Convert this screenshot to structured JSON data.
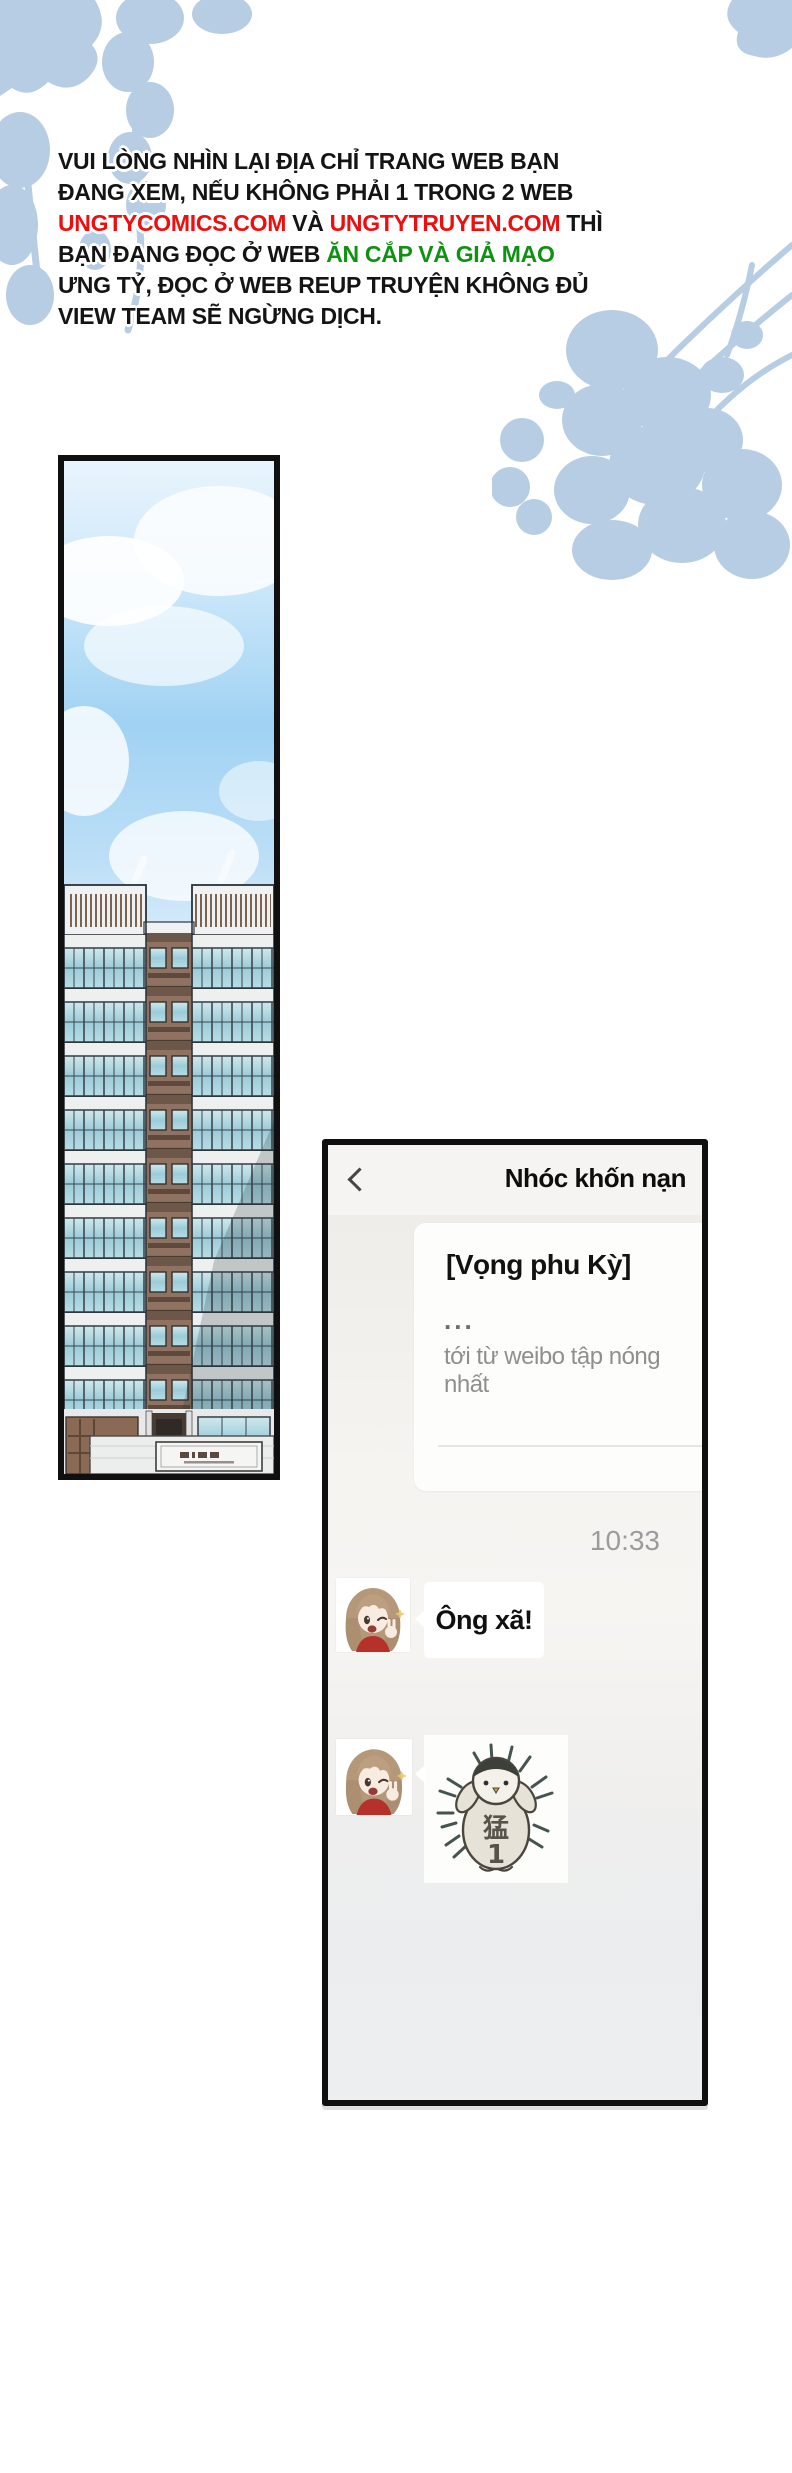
{
  "notice": {
    "line1": "VUI LÒNG NHÌN LẠI ĐỊA CHỈ TRANG WEB BẠN",
    "line2": "ĐANG XEM, NẾU KHÔNG PHẢI 1 TRONG 2 WEB",
    "line3_site1": "UNGTYCOMICS.COM",
    "line3_and": " VÀ ",
    "line3_site2": "UNGTYTRUYEN.COM",
    "line3_end": " THÌ",
    "line4_black": "BẠN ĐANG ĐỌC Ở WEB ",
    "line4_green": "ĂN CẮP VÀ GIẢ MẠO",
    "line5": "ƯNG TỶ, ĐỌC Ở WEB REUP TRUYỆN KHÔNG ĐỦ",
    "line6": "VIEW TEAM SẼ NGỪNG DỊCH.",
    "site_color": "#ef0d0d",
    "alert_color": "#0f9212"
  },
  "chat": {
    "title": "Nhóc khốn nạn",
    "back_icon": "chevron-left",
    "quote_card": {
      "title": "[Vọng phu Kỳ]",
      "ellipsis": "...",
      "source": "tới từ weibo tập nóng nhất"
    },
    "timestamp": "10:33",
    "messages": [
      {
        "type": "text",
        "sender_avatar": "girl-winking",
        "text": "Ông xã!"
      },
      {
        "type": "sticker",
        "sender_avatar": "girl-winking",
        "sticker_icon": "penguin",
        "sticker_char": "猛",
        "sticker_num": "1"
      }
    ]
  },
  "colors": {
    "foliage": "#b7cde4",
    "panel_border": "#101010",
    "chat_header_bg": "#f6f4f2",
    "bubble_bg": "#ffffff",
    "timestamp_gray": "#9b9b9b",
    "sky_blue": "#a5d4f4"
  }
}
